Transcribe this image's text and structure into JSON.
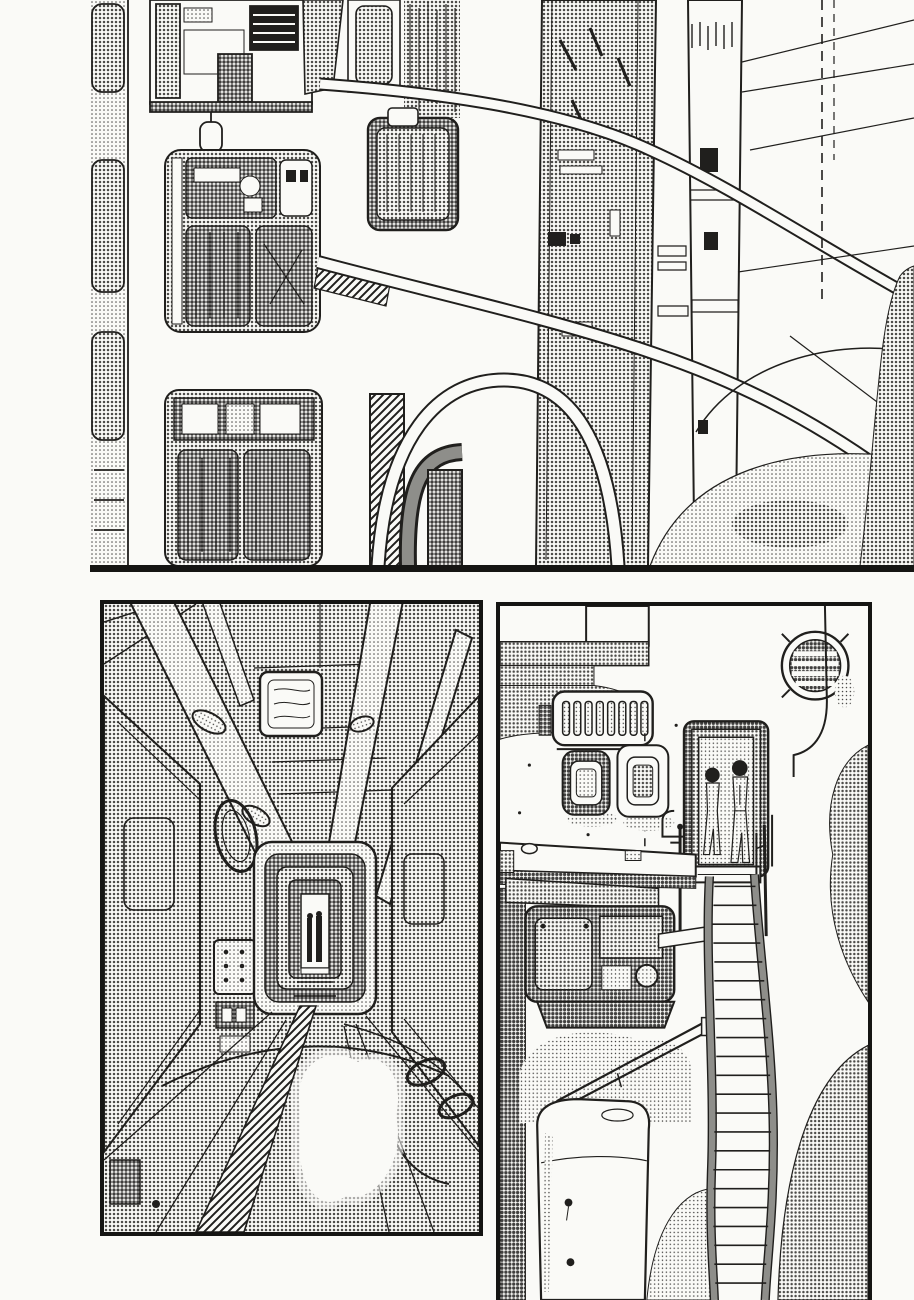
{
  "page": {
    "kind": "manga page, black and white comic artwork",
    "visible_text": "none (wordless page)",
    "panel_count": 3
  },
  "colors": {
    "paper": "#fafaf7",
    "ink": "#201f1d",
    "tone_light": "#dadad6",
    "tone_mid": "#bdbdb9",
    "tone_dark": "#8e8e8a",
    "panel_border": "#151513"
  },
  "panels": [
    {
      "id": "panel-1-megastructure",
      "position": "top, full width; artwork bleeds off top and right edges; black rule along bottom",
      "bbox_px": {
        "left": 90,
        "top": 0,
        "width": 824,
        "height": 572
      },
      "figures": 0,
      "description": "Bird's-eye view of a vast industrial megastructure: banks of pod hatches and machinery bays on the left, a broad halftone tower and a white column in the centre joined by sweeping curved walkways, thin cables running to the right edge, and screentone dust clouds piling up at the lower right."
    },
    {
      "id": "panel-2-corridor",
      "position": "bottom left, fully framed with thick black border",
      "bbox_px": {
        "left": 100,
        "top": 600,
        "width": 383,
        "height": 636
      },
      "figures": 1,
      "description": "One-point-perspective interior of a dim machine corridor: screentone walls, diagonal pipes dropping from the ceiling, a white ceiling vent, a ringed port and button panels on the left wall, a ladder-like track on the floor, a glowing white patch of light, and a nested dark doorway at the centre with a tiny silhouetted figure."
    },
    {
      "id": "panel-3-stairway",
      "position": "bottom right, framed on top/left/right; bleeds off the bottom edge",
      "bbox_px": {
        "left": 496,
        "top": 602,
        "width": 376,
        "height": 698
      },
      "figures": 2,
      "description": "Exterior wall with a round slatted vent fan, a slotted grille, two switch plates and a ledge; two slender figures seen from behind stand in a dark doorway at the top of a long narrow staircase that winds down past a machinery block, a diagonal boom and a white tank, with screentone clouds behind."
    }
  ]
}
